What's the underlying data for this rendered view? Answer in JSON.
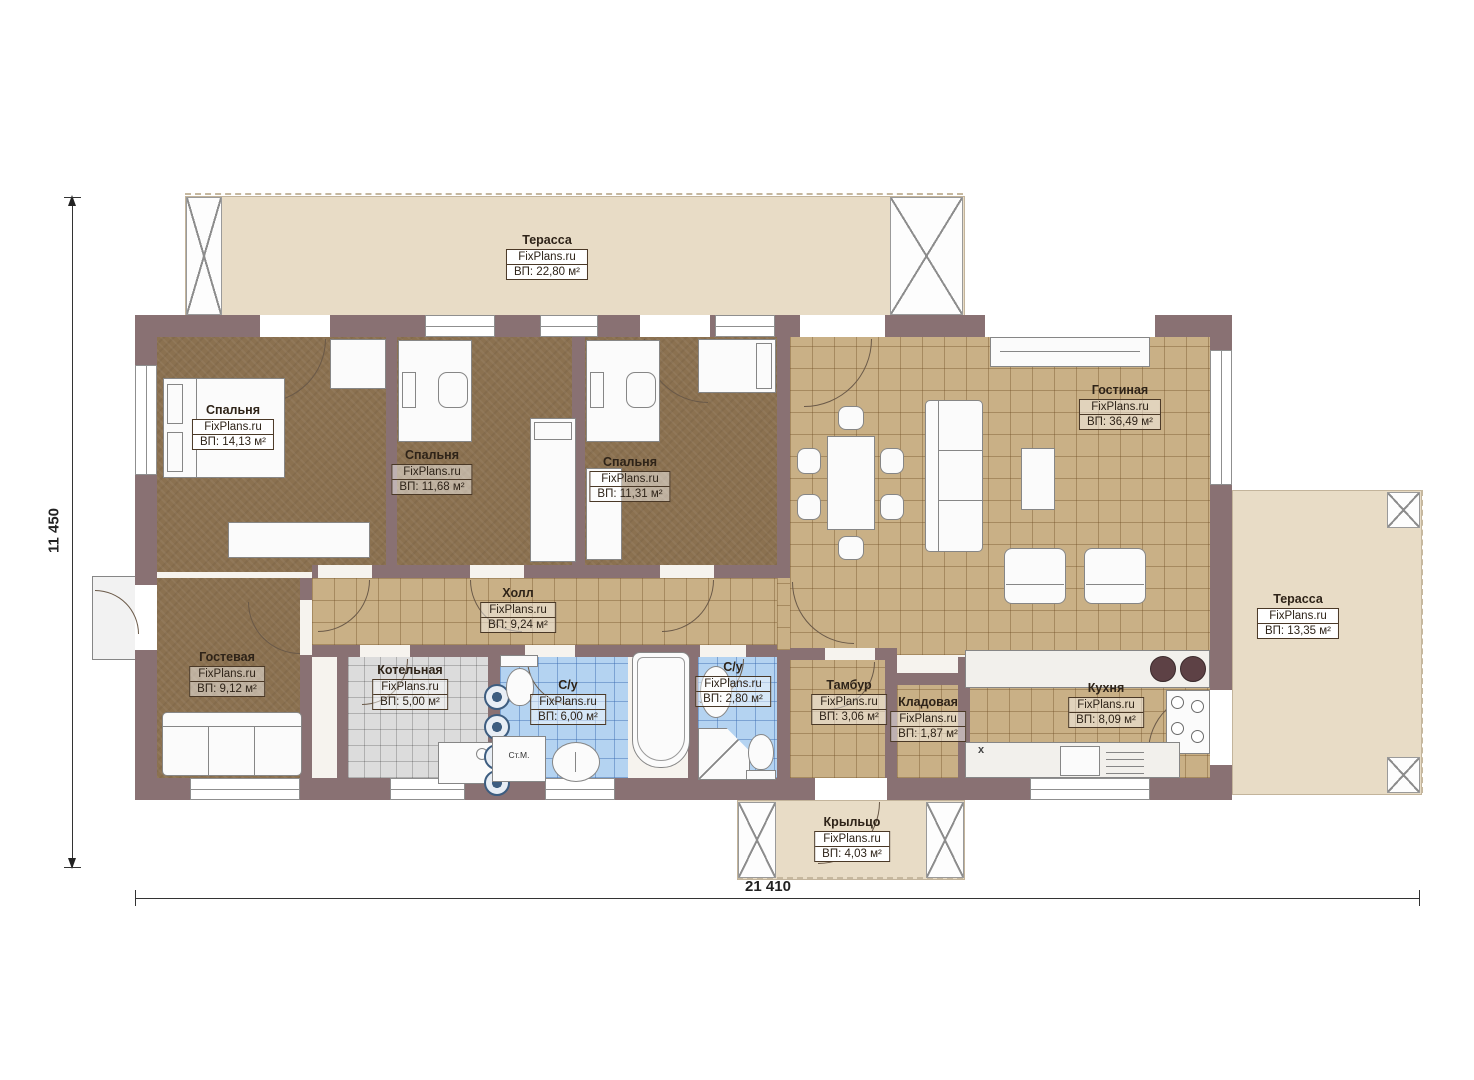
{
  "branding": "FixPlans.ru",
  "dimensions": {
    "height_label": "11 450",
    "width_label": "21 410"
  },
  "rooms": {
    "terrace_top": {
      "name": "Терасса",
      "site": "FixPlans.ru",
      "area": "ВП: 22,80 м²"
    },
    "bedroom1": {
      "name": "Спальня",
      "site": "FixPlans.ru",
      "area": "ВП: 14,13 м²"
    },
    "bedroom2": {
      "name": "Спальня",
      "site": "FixPlans.ru",
      "area": "ВП: 11,68 м²"
    },
    "bedroom3": {
      "name": "Спальня",
      "site": "FixPlans.ru",
      "area": "ВП: 11,31 м²"
    },
    "living": {
      "name": "Гостиная",
      "site": "FixPlans.ru",
      "area": "ВП: 36,49 м²"
    },
    "terrace_right": {
      "name": "Терасса",
      "site": "FixPlans.ru",
      "area": "ВП: 13,35 м²"
    },
    "hall": {
      "name": "Холл",
      "site": "FixPlans.ru",
      "area": "ВП: 9,24 м²"
    },
    "guest": {
      "name": "Гостевая",
      "site": "FixPlans.ru",
      "area": "ВП: 9,12 м²"
    },
    "boiler": {
      "name": "Котельная",
      "site": "FixPlans.ru",
      "area": "ВП: 5,00 м²"
    },
    "bath1": {
      "name": "С/у",
      "site": "FixPlans.ru",
      "area": "ВП: 6,00 м²"
    },
    "bath2": {
      "name": "С/у",
      "site": "FixPlans.ru",
      "area": "ВП: 2,80 м²"
    },
    "tambour": {
      "name": "Тамбур",
      "site": "FixPlans.ru",
      "area": "ВП: 3,06 м²"
    },
    "storage": {
      "name": "Кладовая",
      "site": "FixPlans.ru",
      "area": "ВП: 1,87 м²"
    },
    "kitchen": {
      "name": "Кухня",
      "site": "FixPlans.ru",
      "area": "ВП: 8,09 м²"
    },
    "porch": {
      "name": "Крыльцо",
      "site": "FixPlans.ru",
      "area": "ВП: 4,03 м²"
    }
  },
  "annotations": {
    "washing_machine": "Ст.М.",
    "marker_x": "x"
  }
}
